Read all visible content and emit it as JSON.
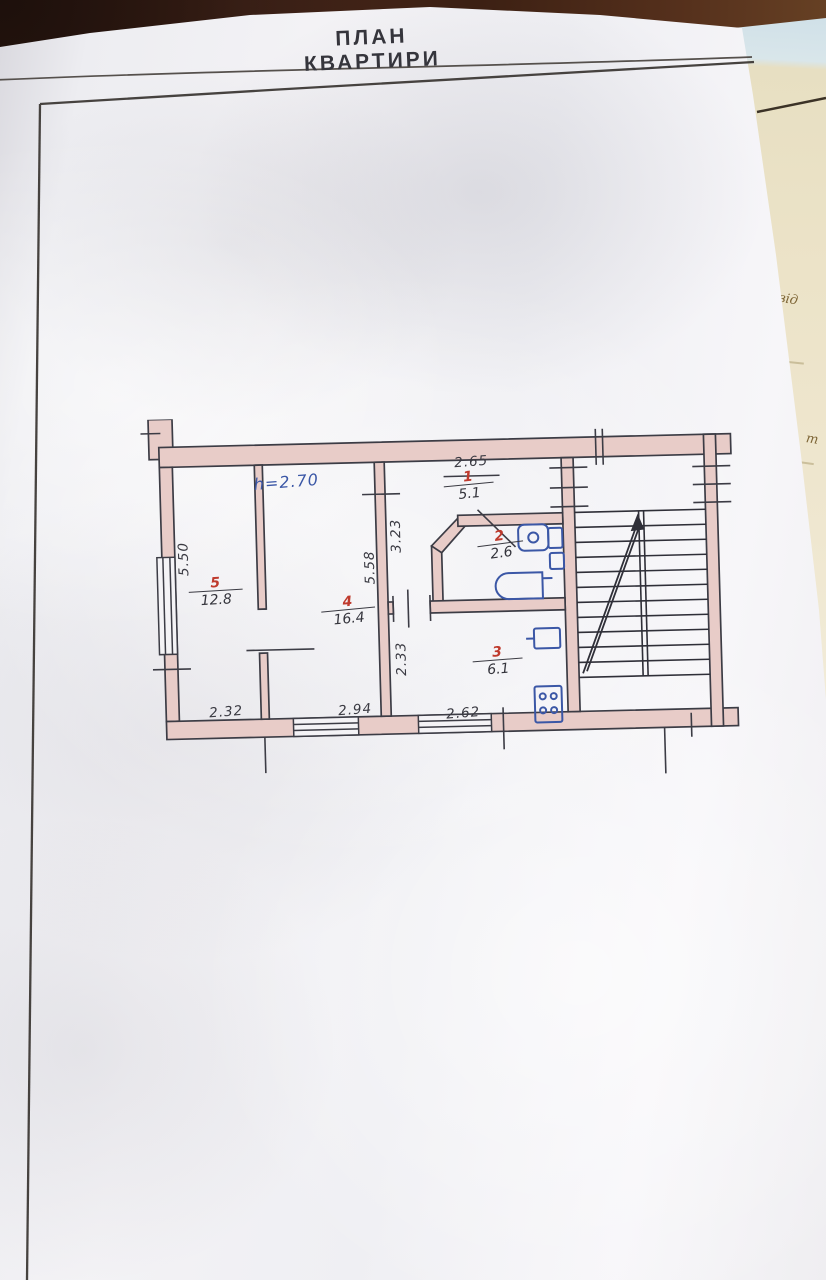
{
  "page": {
    "title": "ПЛАН КВАРТИРИ"
  },
  "side_page": {
    "fragments": {
      "note1": "від",
      "note2": "т"
    }
  },
  "plan": {
    "height_note": "h=2.70",
    "rooms": [
      {
        "number": "1",
        "area": "5.1"
      },
      {
        "number": "2",
        "area": "2.6"
      },
      {
        "number": "3",
        "area": "6.1"
      },
      {
        "number": "4",
        "area": "16.4"
      },
      {
        "number": "5",
        "area": "12.8"
      }
    ],
    "dimensions": {
      "hall_width": "2.65",
      "left_side": "5.50",
      "room4_depth": "5.58",
      "hall_depth": "3.23",
      "kitchen_depth": "2.33",
      "room5_width": "2.32",
      "room4_width": "2.94",
      "kitchen_width": "2.62"
    },
    "colors": {
      "wall_fill": "#e8ccc8",
      "ink": "#3c3c45",
      "red_label": "#bf3a2d",
      "blue_ink": "#3b57a6"
    }
  }
}
